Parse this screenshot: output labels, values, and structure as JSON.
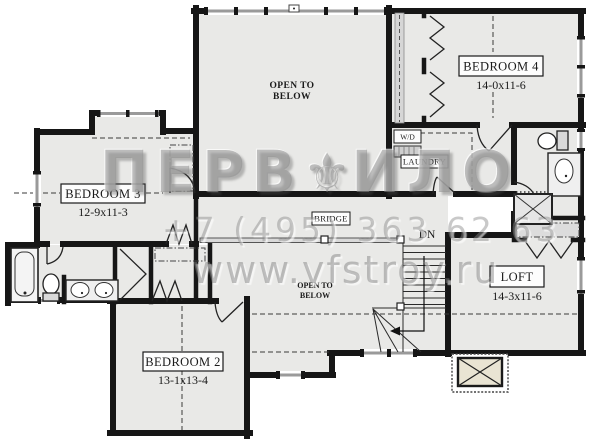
{
  "watermark": {
    "brand_left": "ПЕРВ",
    "brand_mark": "⚜",
    "brand_right": "ИЛО",
    "phone": "+7 (495) 363 62 63",
    "website": "www.vfstroy.ru"
  },
  "rooms": {
    "bedroom3": {
      "name": "BEDROOM 3",
      "dims": "12-9x11-3"
    },
    "bedroom4": {
      "name": "BEDROOM 4",
      "dims": "14-0x11-6"
    },
    "bedroom2": {
      "name": "BEDROOM 2",
      "dims": "13-1x13-4"
    },
    "loft": {
      "name": "LOFT",
      "dims": "14-3x11-6"
    }
  },
  "annotations": {
    "open_to_below_main": {
      "line1": "OPEN TO",
      "line2": "BELOW"
    },
    "open_to_below_small": {
      "line1": "OPEN TO",
      "line2": "BELOW"
    },
    "bridge": "BRIDGE",
    "laundry": "LAUNDRY",
    "washer_dryer": "W/D",
    "stairs_down": "DN"
  },
  "colors": {
    "wall": "#161616",
    "floor": "#e9e9e7",
    "window": "#b9b9b9",
    "chimney": "#e9e4d3",
    "watermark": "#8f8f8f"
  }
}
